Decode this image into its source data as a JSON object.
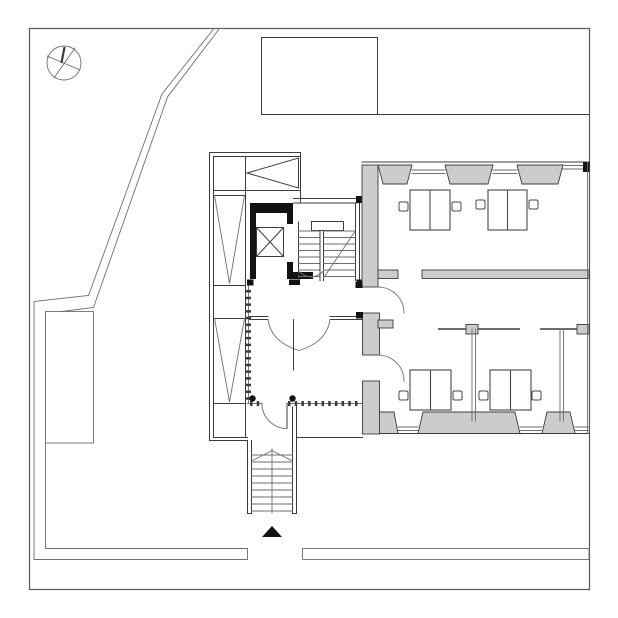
{
  "document": {
    "kind": "architectural-floor-plan",
    "description": "Monochrome site and floor plan: office level with elevator core, internal and external stairs, ramp wing, entrance arrow, and three office rooms with paired desks"
  },
  "colors": {
    "background": "#ffffff",
    "line": "#3c3c3c",
    "line_soft": "#6e6e6e",
    "border": "#5a5a5a",
    "wall_gray": "#cccccc",
    "ink_black": "#121212",
    "desk_stroke": "#484848"
  },
  "symbols": {
    "compass": "compass circle with crossing diameters and north needle",
    "entrance_arrow": "solid black triangle at main entrance",
    "elevator": "black shaft walls with X-crossed car",
    "ramp_direction": "V-shaped direction lines in west wing",
    "stair_break_line": "chevron across external stair"
  },
  "inventory": {
    "office_rooms": 3,
    "desk_groups": 4,
    "chairs": 8,
    "stairs": 2,
    "elevators": 1,
    "door_swings": 5,
    "windows_north_wall": 2,
    "windows_south_wall": 3,
    "structural_columns": 2
  }
}
